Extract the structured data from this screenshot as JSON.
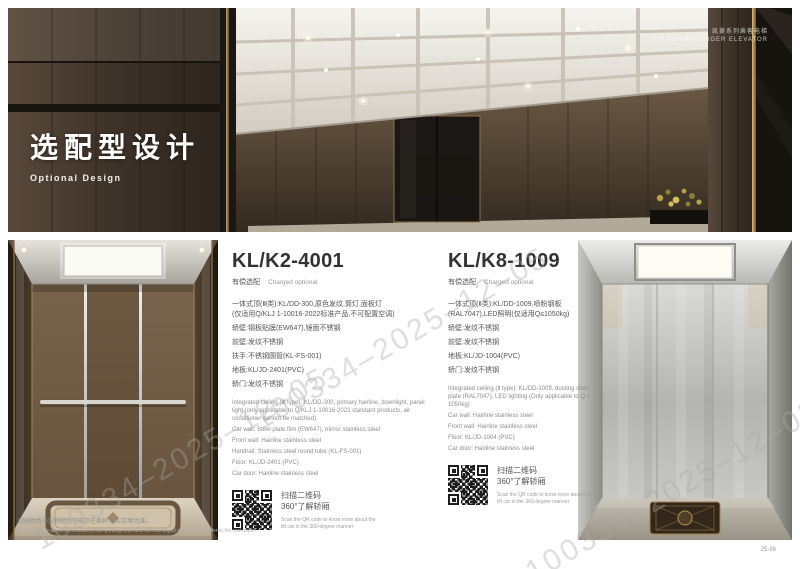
{
  "page": {
    "watermark": "100334–2025–12–05",
    "page_number": "25-26",
    "footnote_zh": "印刷颜色与实物颜色可能存在差异,请以实物为准。",
    "footnote_en": "There may be differences between the printing color and the real object color. Please refer to the real object."
  },
  "hero": {
    "title_zh": "选配型设计",
    "title_en": "Optional Design",
    "series_zh": "凯菱系列乘客电梯",
    "series_en": "KLAS-PASSENGER ELEVATOR"
  },
  "products": [
    {
      "model": "KL/K2-4001",
      "charged_zh": "有偿选配",
      "charged_en": "Charged optional",
      "specs_zh": [
        "一体式顶(Ⅲ类):KL/DD-300,原色发纹,筒灯,面板灯",
        "(仅适用Q/KLJ 1-10016-2022标准产品,不可配置空调)",
        "轿壁:钢板贴膜(EW647),镜面不锈钢",
        "前壁:发纹不锈钢",
        "扶手:不锈钢圆管(KL-FS-001)",
        "地板:KL/JD-2401(PVC)",
        "轿门:发纹不锈钢"
      ],
      "specs_en": [
        "Integrated ceiling (Ⅲ type): KL/DD-300, primary hairline, downlight, panel light (only applicable to Q/KLJ 1-10016-2022 standard products, air conditioner cannot be matched)",
        "Car wall: Steel plate film (EW647), mirror stainless steel",
        "Front wall: Hairline stainless steel",
        "Handrail: Stainless steel round tube (KL-FS-001)",
        "Floor: KL/JD-2401 (PVC)",
        "Car door: Hairline stainless steel"
      ],
      "qr_zh_1": "扫描二维码",
      "qr_zh_2": "360°了解轿厢",
      "qr_en": "Scan the QR code to know more about the lift car in the 360-degree manner"
    },
    {
      "model": "KL/K8-1009",
      "charged_zh": "有偿选配",
      "charged_en": "Charged optional",
      "specs_zh": [
        "一体式顶(Ⅱ类):KL/DD-1009,喷粉钢板",
        "(RAL7047),LED照明(仅适用Q≤1050kg)",
        "轿壁:发纹不锈钢",
        "前壁:发纹不锈钢",
        "地板:KL/JD-1004(PVC)",
        "轿门:发纹不锈钢"
      ],
      "specs_en": [
        "Integrated ceiling (Ⅱ type): KL/DD-1009, dusting steel plate (RAL7047), LED lighting (Only applicable to Q ≤ 1050kg)",
        "Car wall: Hairline stainless steel",
        "Front wall: Hairline stainless steel",
        "Floor: KL/JD-1004 (PVC)",
        "Car door: Hairline stainless steel"
      ],
      "qr_zh_1": "扫描二维码",
      "qr_zh_2": "360°了解轿厢",
      "qr_en": "Scan the QR code to know more about the lift car in the 360-degree manner"
    }
  ],
  "colors": {
    "accent_gold": "#b08d57",
    "wood_dark": "#3c3128",
    "text_dark": "#333333",
    "text_gray": "#888888"
  }
}
